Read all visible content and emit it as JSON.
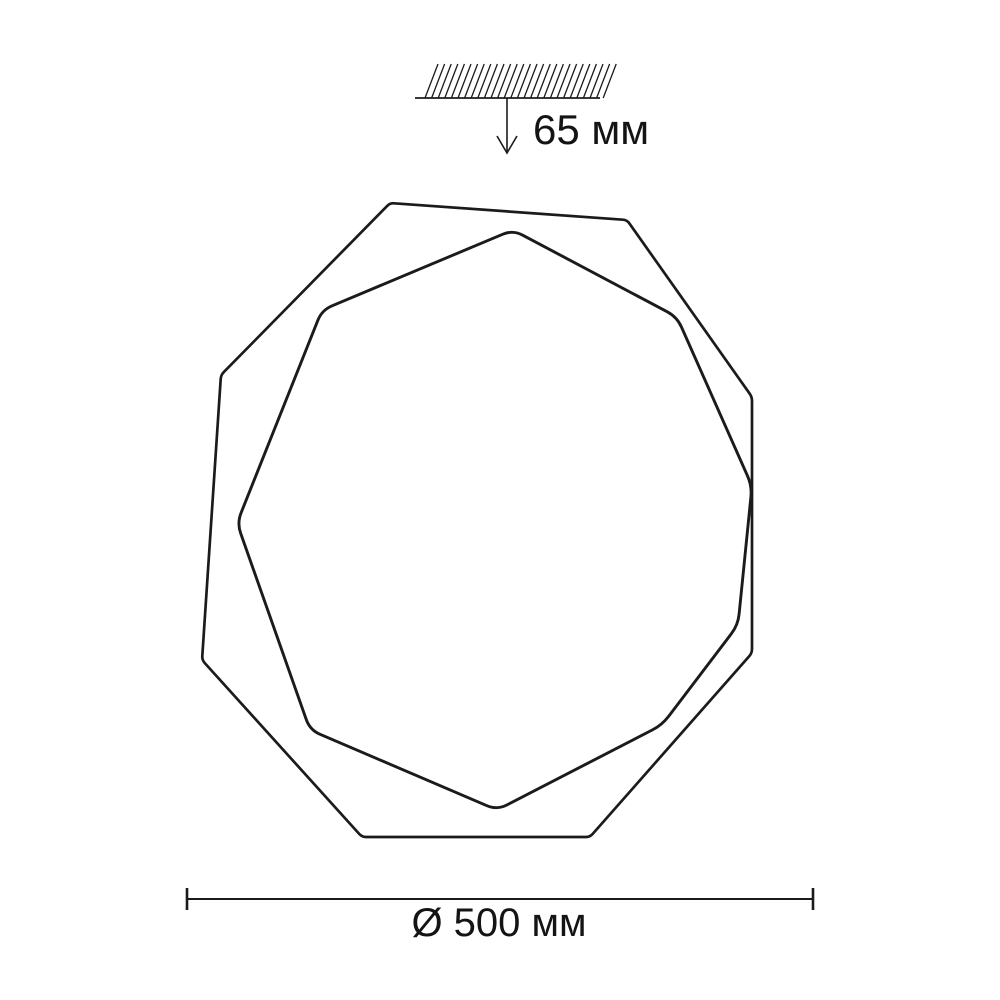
{
  "labels": {
    "mount_depth": "65 мм",
    "diameter": "Ø 500 мм"
  },
  "colors": {
    "line": "#1b1b1b",
    "text": "#141414",
    "background": "#ffffff"
  },
  "geometry": {
    "ceiling": {
      "line": {
        "x1": 415,
        "x2": 600,
        "y": 98,
        "width": 1.8
      },
      "hatch": {
        "x_start": 425,
        "spacing": 6.6,
        "count": 28,
        "slant": 13,
        "height": 34,
        "width": 1.3
      }
    },
    "arrow": {
      "x": 507,
      "y_top": 98,
      "y_tip": 153,
      "head_half_width": 10,
      "head_height": 17,
      "width": 1.6
    },
    "outer_polygon": {
      "corner_radius": 4,
      "stroke_width": 2.7,
      "points": [
        [
          390,
          203
        ],
        [
          627,
          220
        ],
        [
          752,
          397
        ],
        [
          752,
          653
        ],
        [
          590,
          837
        ],
        [
          362,
          837
        ],
        [
          202,
          660
        ],
        [
          221,
          375
        ]
      ]
    },
    "inner_polygon": {
      "corner_radius": 11,
      "stroke_width": 2.9,
      "points": [
        [
          513,
          230
        ],
        [
          677,
          317
        ],
        [
          752,
          486
        ],
        [
          738,
          625
        ],
        [
          662,
          725
        ],
        [
          497,
          810
        ],
        [
          310,
          730
        ],
        [
          237,
          523
        ],
        [
          322,
          310
        ]
      ]
    },
    "dimension": {
      "x1": 187,
      "x2": 813,
      "y": 899,
      "tick_top": 888,
      "tick_bottom": 910,
      "line_width": 2,
      "tick_width": 2.6
    },
    "text": {
      "mount_depth": {
        "x": 533,
        "y": 144,
        "size": 42,
        "anchor": "start"
      },
      "diameter": {
        "x": 499,
        "y": 936,
        "size": 40,
        "anchor": "middle"
      }
    }
  }
}
